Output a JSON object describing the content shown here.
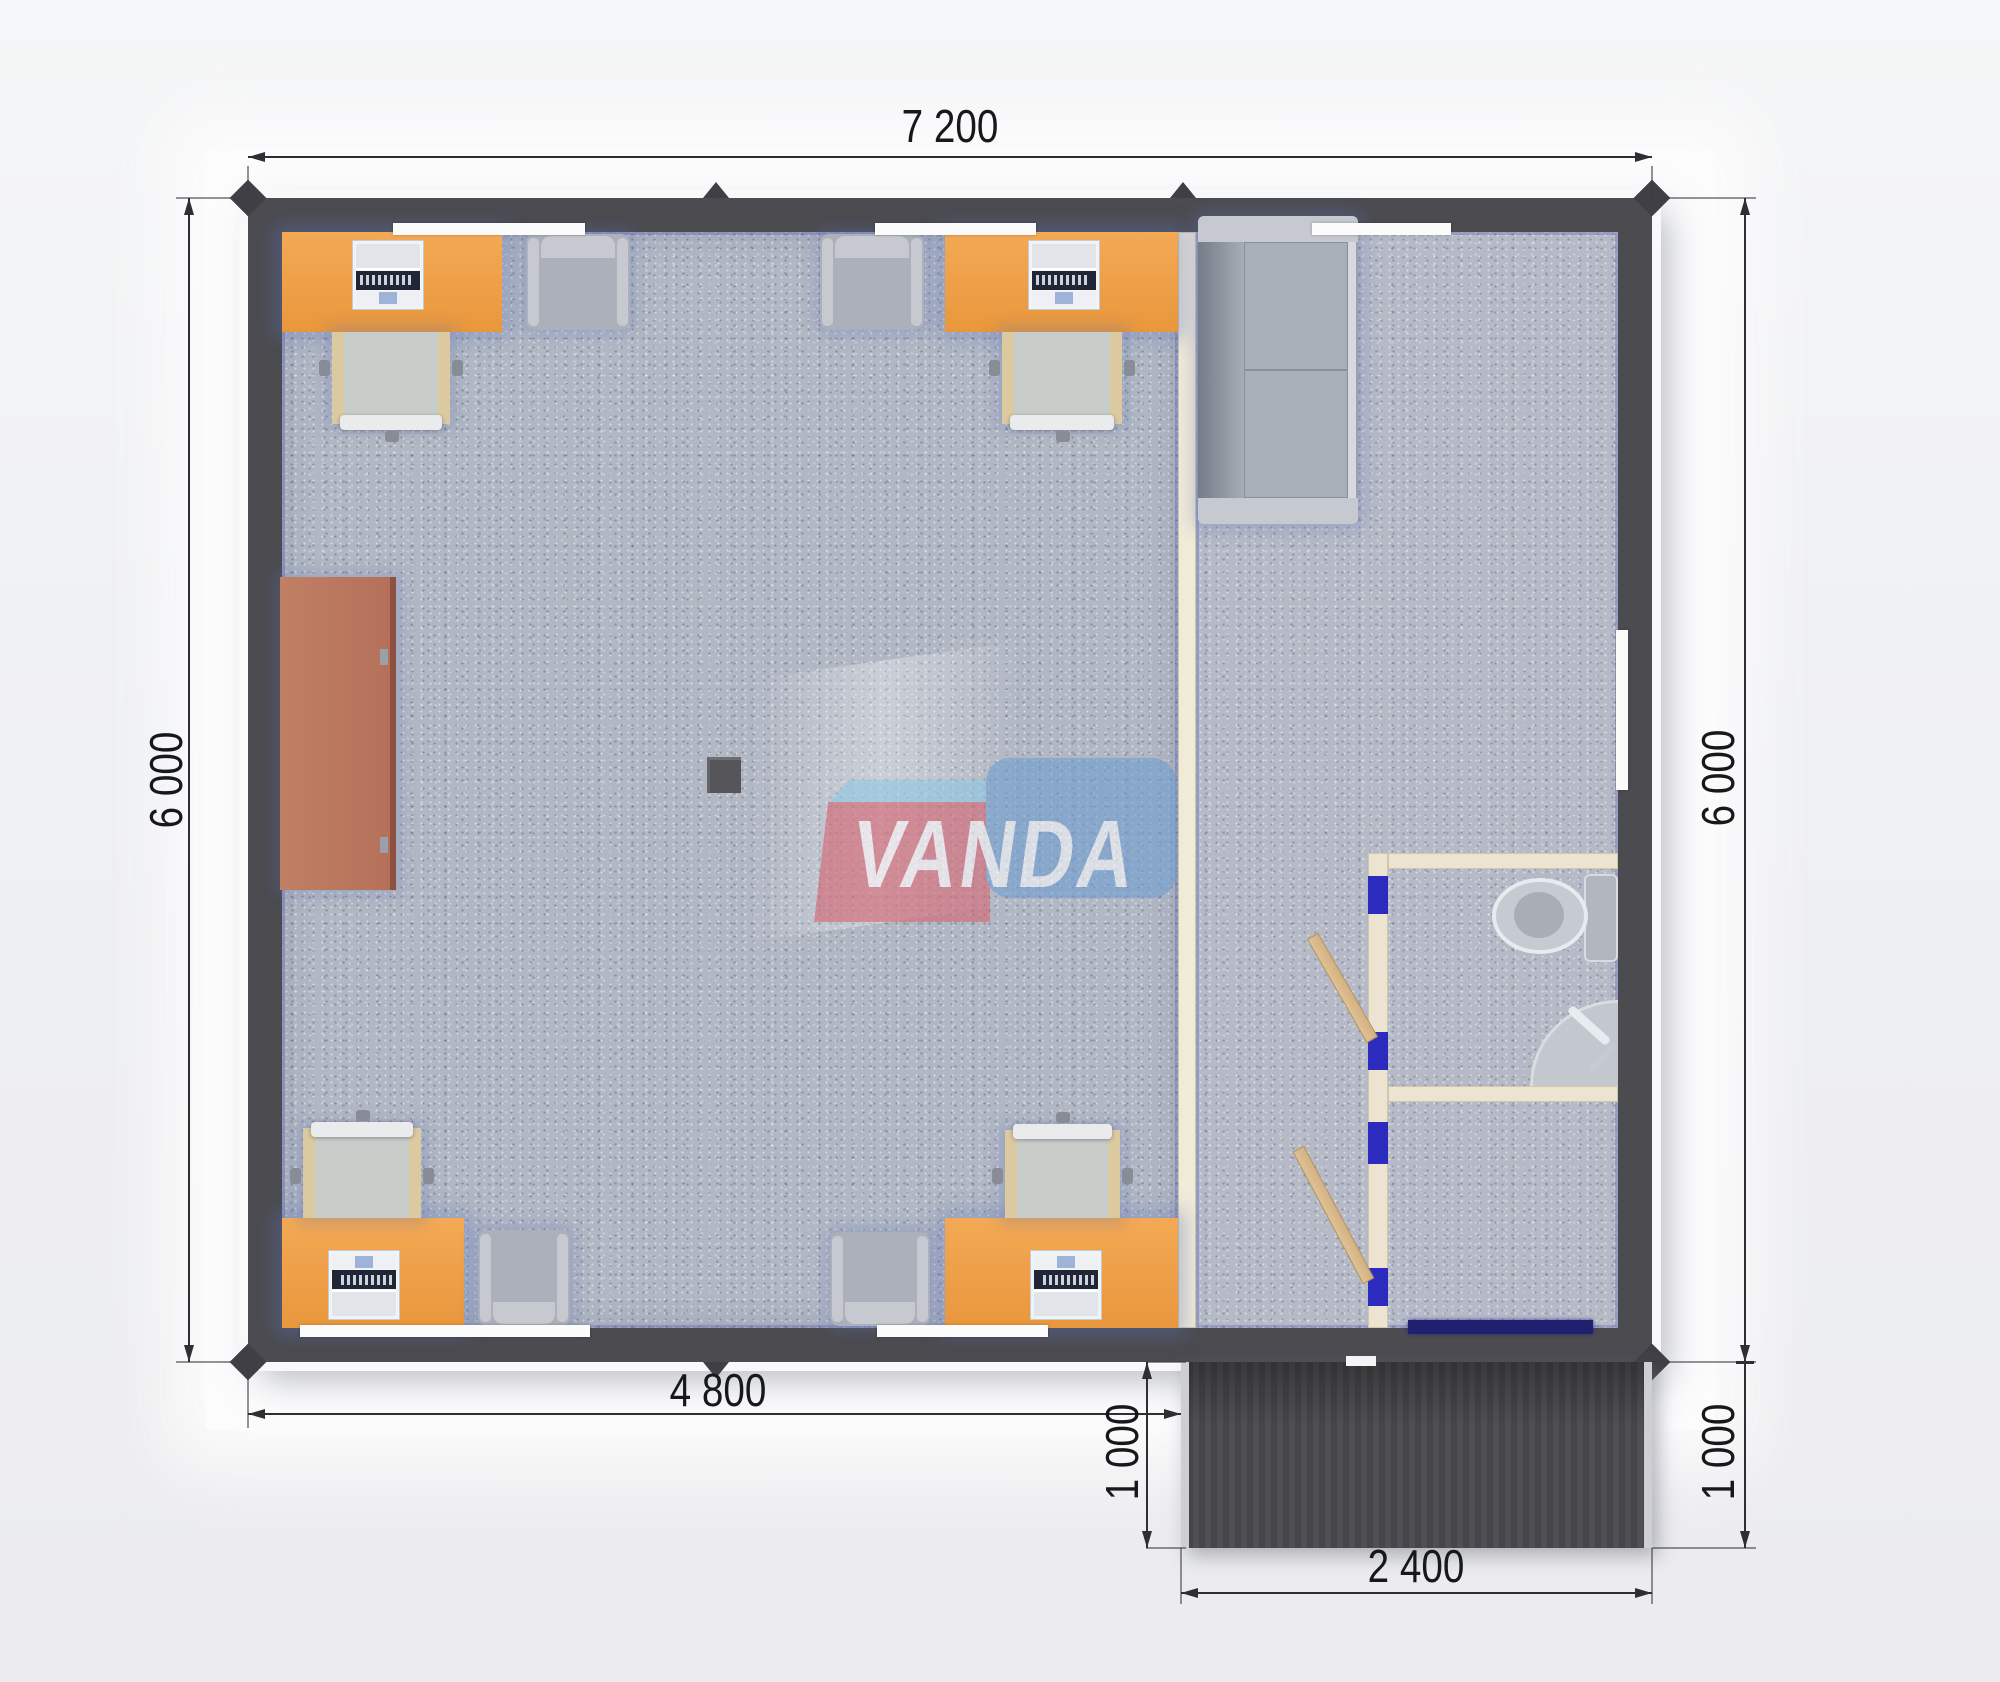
{
  "title": "VANDA modular office floor plan render",
  "watermark": {
    "brand": "VANDA"
  },
  "dimension_labels": {
    "top_width": "7 200",
    "left_height": "6 000",
    "right_height": "6 000",
    "bottom_width": "4 800",
    "porch_height_left": "1 000",
    "porch_height_right": "1 000",
    "porch_width": "2 400"
  },
  "colors": {
    "wall": "#4b4b50",
    "floor": "#b1b7c3",
    "desk": "#e9973c",
    "desk_hi": "#f3a955",
    "partition": "#ece4d0",
    "door_frame_blue": "#2b2bbd",
    "entrance_door": "#20206e",
    "door_wood": "#d3b183",
    "porch": "#4a4a4e",
    "sideboard": "#b5705a",
    "sofa": "#9ba1ac",
    "chair_wood": "#dbc9a0",
    "chair_seat": "#c9cdc9",
    "armchair": "#abb0ba",
    "armchair_arm": "#c6c9cf",
    "fixture": "#c3c7ce",
    "logo_red": "#d4626f",
    "logo_blue": "#6f9ecf",
    "logo_flap": "#8ec7e3",
    "dim": "#2f2f33"
  },
  "furniture_icons": [
    "office-desk",
    "laptop",
    "desk-chair",
    "armchair",
    "sofa",
    "sideboard",
    "support-column",
    "toilet",
    "corner-sink",
    "door-leaf",
    "porch-deck"
  ]
}
